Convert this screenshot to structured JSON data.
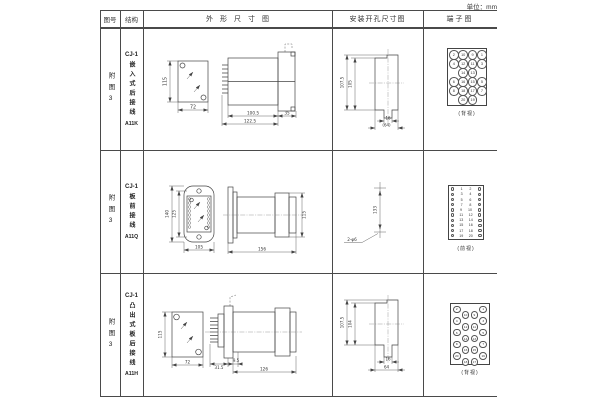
{
  "unit": "单位：mm",
  "header": {
    "fig": "图号",
    "structure": "结构",
    "outline": "外形尺寸图",
    "install": "安装开孔尺寸图",
    "terminal": "端子图"
  },
  "rows": [
    {
      "fig": "附图3",
      "model": "CJ-1",
      "type": "嵌入式后接线",
      "code": "A11K",
      "dims": {
        "front_h": "115",
        "front_w": "72",
        "side_body": "100.5",
        "side_total": "122.5",
        "side_flange": "35",
        "inst_outer": "107.5",
        "inst_inner": "105",
        "inst_notch": "16",
        "inst_width": "(64)"
      },
      "terminal": {
        "view": "(背视)",
        "grid": [
          [
            "2",
            "10",
            "9",
            "1"
          ],
          [
            "4",
            "12",
            "11",
            "3"
          ],
          [
            "",
            "14",
            "13",
            ""
          ],
          [
            "6",
            "16",
            "15",
            "5"
          ],
          [
            "8",
            "18",
            "17",
            "7"
          ],
          [
            "",
            "20",
            "19",
            ""
          ]
        ]
      }
    },
    {
      "fig": "附图3",
      "model": "CJ-1",
      "type": "板前接线",
      "code": "A11Q",
      "dims": {
        "front_outer": "140",
        "front_inner": "125",
        "front_w": "105",
        "side_total": "156",
        "side_h": "115",
        "inst_spacing": "133",
        "inst_holes": "2-φ6"
      },
      "terminal": {
        "view": "(前视)",
        "pairs": [
          [
            "1",
            "2"
          ],
          [
            "3",
            "4"
          ],
          [
            "5",
            "6"
          ],
          [
            "7",
            "8"
          ],
          [
            "9",
            "10"
          ],
          [
            "11",
            "12"
          ],
          [
            "13",
            "14"
          ],
          [
            "15",
            "16"
          ],
          [
            "17",
            "18"
          ],
          [
            "19",
            "20"
          ]
        ]
      }
    },
    {
      "fig": "附图3",
      "model": "CJ-1",
      "type": "凸出式板后接线",
      "code": "A11H",
      "dims": {
        "front_h": "115",
        "front_w": "72",
        "side_a": "31.5",
        "side_b": "9.5",
        "side_total": "126",
        "inst_outer": "107.5",
        "inst_inner": "104",
        "inst_notch": "16",
        "inst_width": "64"
      },
      "terminal": {
        "view": "(背视)",
        "grid": [
          [
            "2",
            "",
            "",
            "1"
          ],
          [
            "",
            "10",
            "9",
            ""
          ],
          [
            "4",
            "",
            "",
            "3"
          ],
          [
            "",
            "12",
            "11",
            ""
          ],
          [
            "6",
            "",
            "",
            "5"
          ],
          [
            "",
            "14",
            "13",
            ""
          ],
          [
            "8",
            "",
            "",
            "7"
          ],
          [
            "",
            "16",
            "15",
            ""
          ],
          [
            "20",
            "",
            "",
            "19"
          ],
          [
            "",
            "18",
            "17",
            ""
          ]
        ]
      }
    }
  ]
}
